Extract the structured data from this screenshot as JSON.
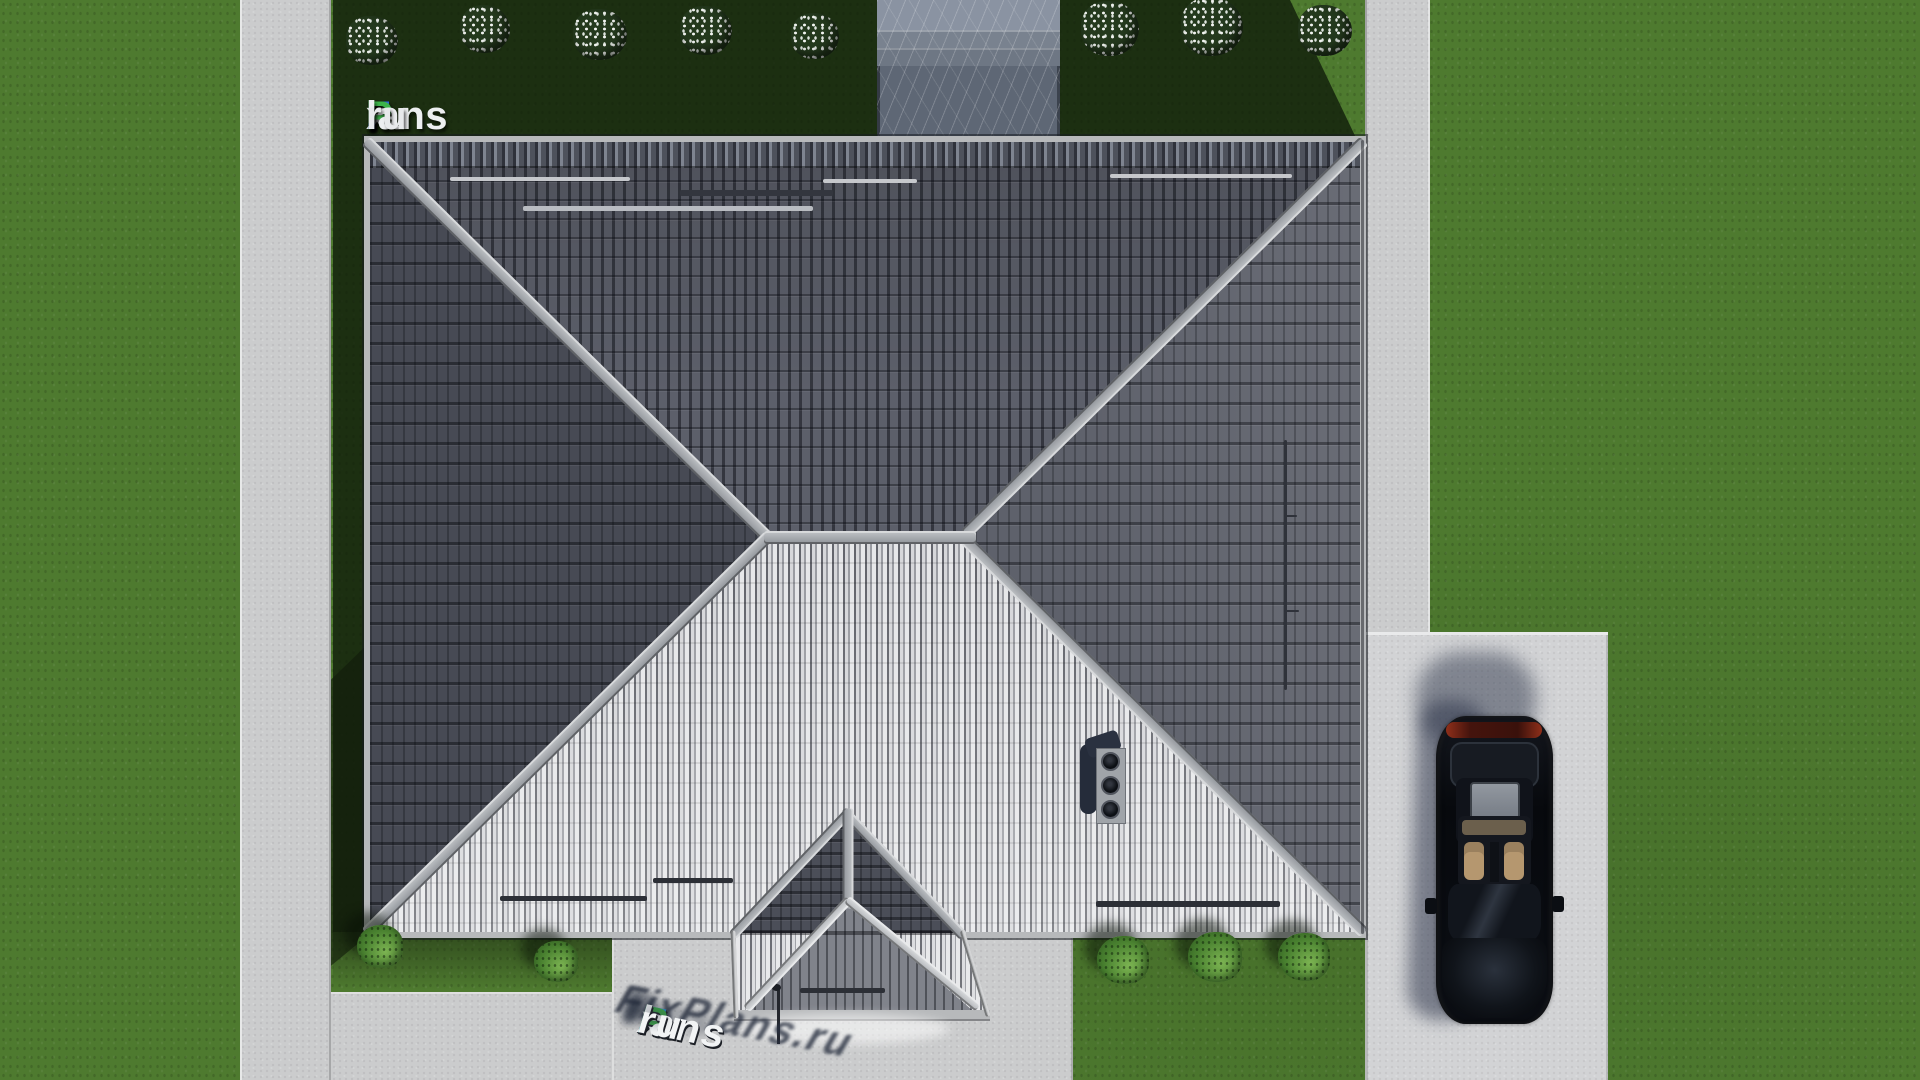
{
  "scene": {
    "view": "top-down aerial 3D render",
    "subject": "hip-roof house with gabled entrance porch, yard, walkways, terrace and parked sedan",
    "roof_vents_count": 3,
    "flower_bushes_count": 8,
    "green_bushes_count": 5
  },
  "branding": {
    "watermark_top": {
      "text": "FixPlans.ru",
      "segments": [
        {
          "text": "F",
          "color": "#2d6ce7"
        },
        {
          "text": "i",
          "color": "#3db44b"
        },
        {
          "text": "x",
          "color": "#edeff1"
        },
        {
          "text": "P",
          "color": "#3db44b"
        },
        {
          "text": "lans",
          "color": "#edeff1"
        },
        {
          "text": ".",
          "color": "#2d6ce7"
        },
        {
          "text": "ru",
          "color": "#e7e9eb"
        }
      ]
    },
    "watermark_ground": {
      "text": "FixPlans.ru",
      "segments": [
        {
          "text": "F",
          "color": "#2f9fe0"
        },
        {
          "text": "i",
          "color": "#46c24e"
        },
        {
          "text": "x",
          "color": "#f2f4f5"
        },
        {
          "text": "P",
          "color": "#46c24e"
        },
        {
          "text": "lans",
          "color": "#f2f4f5"
        },
        {
          "text": ".",
          "color": "#2f9fe0"
        },
        {
          "text": "ru",
          "color": "#f2f4f5"
        }
      ]
    }
  },
  "palette": {
    "grass": "#4e7a2f",
    "grass_shadow": "rgba(14,26,9,0.78)",
    "path": "#cbcccd",
    "driveway": "#d2d3d5",
    "roof_north": "#5c5f6a",
    "roof_west": "#474a54",
    "roof_east": "#5e616b",
    "roof_south_light": "#d6d7da",
    "roof_south_mid": "#9a9ca2",
    "ridge": "#9da1a6",
    "fascia": "#b7b9bb",
    "terrace": "#5e6775",
    "car_body": "#0b0e14",
    "car_interior": "#b5976f",
    "bush_green": "#4a8230",
    "tail_light": "#8f2f1a"
  }
}
